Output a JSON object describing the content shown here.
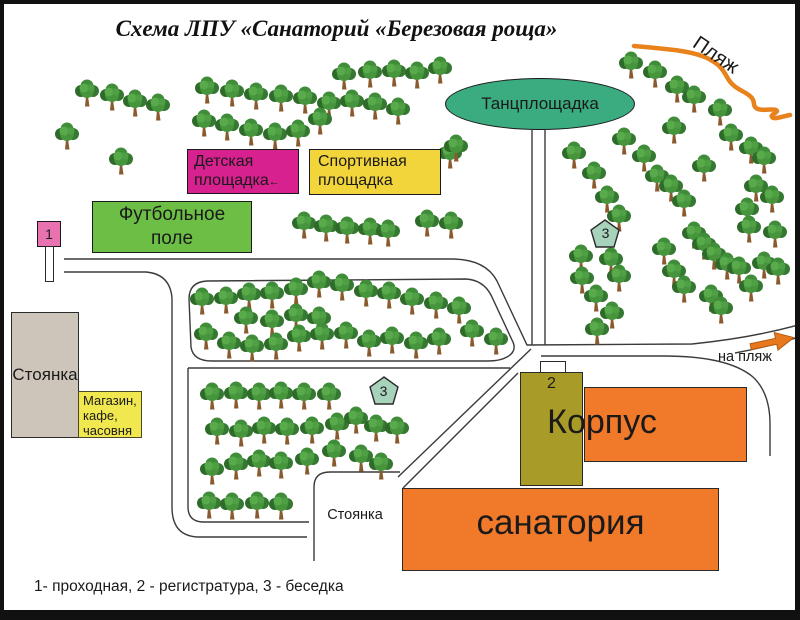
{
  "title": "Схема ЛПУ «Санаторий «Березовая роща»",
  "legend": "1- проходная, 2 - регистратура, 3 - беседка",
  "beach": {
    "label": "Пляж",
    "direction_label": "на пляж"
  },
  "areas": {
    "dance_floor": "Танцплощадка",
    "children_playground": [
      "Детская",
      "площадка"
    ],
    "children_playground_arrow": "←",
    "sports_ground": [
      "Спортивная",
      "площадка"
    ],
    "football_field": [
      "Футбольное",
      "поле"
    ],
    "parking_left": "Стоянка",
    "shop": [
      "Магазин,",
      "кафе,",
      "часовня"
    ],
    "parking_bottom": "Стоянка",
    "building_word_top": "Корпус",
    "building_word_bottom": "санатория"
  },
  "markers": {
    "checkpoint": "1",
    "registry": "2",
    "gazebo_north": "3",
    "gazebo_west": "3"
  },
  "colors": {
    "dance_floor": "#3bab80",
    "children_playground": "#d6218f",
    "sports_ground": "#f2d43b",
    "football_field": "#6cbe45",
    "checkpoint_box": "#e873b0",
    "parking": "#cdc5b9",
    "shop": "#f0e84e",
    "registry_building": "#a89b28",
    "sanatorium_buildings": "#f0792a",
    "gazebo_marker": "#a7d3bc",
    "beach_line": "#e8821c",
    "road_line": "#3b3b3b",
    "tree_green": "#3f8c39"
  },
  "trees": [
    [
      83,
      90
    ],
    [
      108,
      94
    ],
    [
      131,
      100
    ],
    [
      154,
      104
    ],
    [
      63,
      133
    ],
    [
      117,
      158
    ],
    [
      203,
      87
    ],
    [
      228,
      90
    ],
    [
      252,
      93
    ],
    [
      277,
      95
    ],
    [
      301,
      97
    ],
    [
      325,
      102
    ],
    [
      200,
      120
    ],
    [
      223,
      124
    ],
    [
      247,
      129
    ],
    [
      271,
      133
    ],
    [
      294,
      130
    ],
    [
      316,
      118
    ],
    [
      340,
      73
    ],
    [
      366,
      71
    ],
    [
      390,
      70
    ],
    [
      413,
      72
    ],
    [
      436,
      67
    ],
    [
      348,
      100
    ],
    [
      371,
      103
    ],
    [
      394,
      108
    ],
    [
      446,
      152
    ],
    [
      452,
      145
    ],
    [
      627,
      62
    ],
    [
      651,
      71
    ],
    [
      673,
      86
    ],
    [
      690,
      96
    ],
    [
      716,
      109
    ],
    [
      670,
      127
    ],
    [
      727,
      134
    ],
    [
      747,
      147
    ],
    [
      760,
      157
    ],
    [
      620,
      138
    ],
    [
      640,
      155
    ],
    [
      653,
      175
    ],
    [
      667,
      185
    ],
    [
      680,
      200
    ],
    [
      570,
      152
    ],
    [
      590,
      172
    ],
    [
      603,
      196
    ],
    [
      615,
      215
    ],
    [
      700,
      165
    ],
    [
      752,
      185
    ],
    [
      768,
      196
    ],
    [
      743,
      208
    ],
    [
      745,
      226
    ],
    [
      771,
      231
    ],
    [
      690,
      232
    ],
    [
      700,
      243
    ],
    [
      710,
      253
    ],
    [
      660,
      248
    ],
    [
      670,
      270
    ],
    [
      680,
      286
    ],
    [
      577,
      255
    ],
    [
      607,
      258
    ],
    [
      615,
      275
    ],
    [
      578,
      277
    ],
    [
      592,
      295
    ],
    [
      608,
      312
    ],
    [
      593,
      328
    ],
    [
      707,
      295
    ],
    [
      717,
      307
    ],
    [
      723,
      263
    ],
    [
      735,
      267
    ],
    [
      747,
      285
    ],
    [
      760,
      262
    ],
    [
      774,
      268
    ],
    [
      300,
      222
    ],
    [
      322,
      225
    ],
    [
      343,
      227
    ],
    [
      366,
      228
    ],
    [
      384,
      230
    ],
    [
      423,
      220
    ],
    [
      447,
      222
    ],
    [
      198,
      298
    ],
    [
      222,
      297
    ],
    [
      245,
      293
    ],
    [
      268,
      292
    ],
    [
      292,
      288
    ],
    [
      315,
      281
    ],
    [
      338,
      284
    ],
    [
      362,
      290
    ],
    [
      385,
      292
    ],
    [
      408,
      298
    ],
    [
      432,
      302
    ],
    [
      455,
      307
    ],
    [
      242,
      317
    ],
    [
      268,
      320
    ],
    [
      292,
      314
    ],
    [
      315,
      317
    ],
    [
      202,
      333
    ],
    [
      225,
      342
    ],
    [
      248,
      345
    ],
    [
      272,
      343
    ],
    [
      295,
      335
    ],
    [
      318,
      333
    ],
    [
      342,
      332
    ],
    [
      365,
      340
    ],
    [
      388,
      337
    ],
    [
      412,
      342
    ],
    [
      435,
      338
    ],
    [
      468,
      330
    ],
    [
      492,
      338
    ],
    [
      208,
      393
    ],
    [
      232,
      392
    ],
    [
      255,
      393
    ],
    [
      277,
      392
    ],
    [
      300,
      393
    ],
    [
      325,
      393
    ],
    [
      213,
      428
    ],
    [
      237,
      430
    ],
    [
      260,
      427
    ],
    [
      283,
      428
    ],
    [
      308,
      427
    ],
    [
      333,
      423
    ],
    [
      352,
      417
    ],
    [
      372,
      425
    ],
    [
      393,
      427
    ],
    [
      208,
      468
    ],
    [
      232,
      463
    ],
    [
      255,
      460
    ],
    [
      277,
      462
    ],
    [
      303,
      458
    ],
    [
      330,
      450
    ],
    [
      357,
      455
    ],
    [
      377,
      463
    ],
    [
      205,
      502
    ],
    [
      228,
      503
    ],
    [
      253,
      502
    ],
    [
      277,
      503
    ]
  ]
}
